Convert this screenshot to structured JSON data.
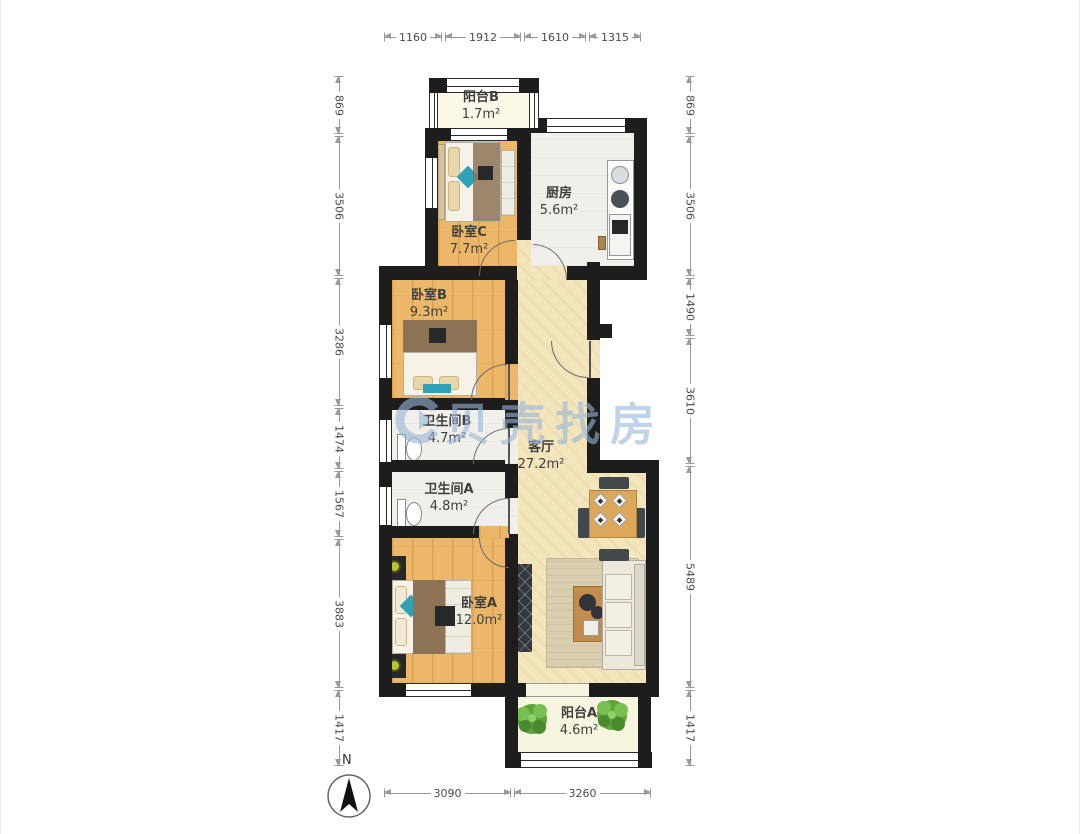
{
  "watermark": {
    "text": "贝壳找房"
  },
  "compass": {
    "north_label": "N"
  },
  "rooms": {
    "balconyB": {
      "name": "阳台B",
      "area": "1.7m²"
    },
    "kitchen": {
      "name": "厨房",
      "area": "5.6m²"
    },
    "bedroomC": {
      "name": "卧室C",
      "area": "7.7m²"
    },
    "bedroomB": {
      "name": "卧室B",
      "area": "9.3m²"
    },
    "bathroomB": {
      "name": "卫生间B",
      "area": "4.7m²"
    },
    "bathroomA": {
      "name": "卫生间A",
      "area": "4.8m²"
    },
    "living": {
      "name": "客厅",
      "area": "27.2m²"
    },
    "bedroomA": {
      "name": "卧室A",
      "area": "12.0m²"
    },
    "balconyA": {
      "name": "阳台A",
      "area": "4.6m²"
    }
  },
  "dims": {
    "top": [
      "1160",
      "1912",
      "1610",
      "1315"
    ],
    "bottom": [
      "3090",
      "3260"
    ],
    "left": [
      "869",
      "3506",
      "3286",
      "1474",
      "1567",
      "3883",
      "1417"
    ],
    "right": [
      "869",
      "3506",
      "1490",
      "3610",
      "5489",
      "1417"
    ]
  },
  "colors": {
    "wall": "#1d1d1d",
    "wood_floor": "#ecb768",
    "living_floor": "#f3e5bc",
    "tile_floor": "#f1efe9",
    "balcony_floor": "#fbf8e8",
    "watermark_blue": "#96b6d8",
    "accent_teal": "#2fa3b5"
  }
}
